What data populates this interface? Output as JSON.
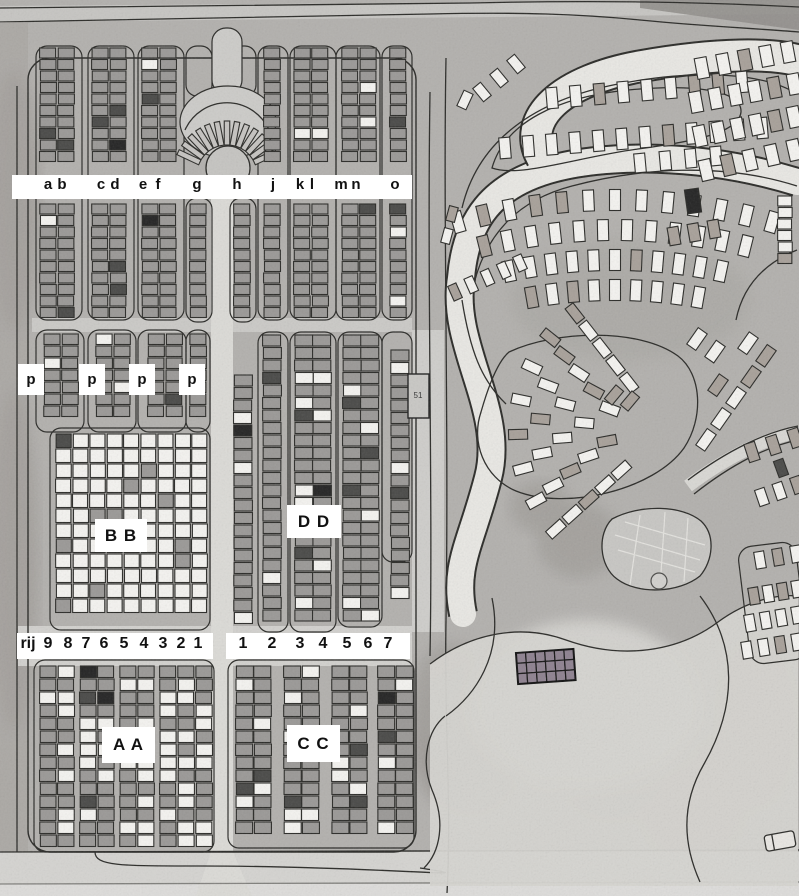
{
  "map": {
    "type": "cemetery-aerial-plan",
    "colors": {
      "background": "#b3b1ae",
      "road": "#dcdbd7",
      "bright_path": "#e9e8e4",
      "outline": "#2b2b28",
      "grave_gray": "#9b9997",
      "grave_light": "#f4f3f0",
      "grave_tan": "#a8a19a",
      "grave_dark": "#4a4a48",
      "grave_black": "#242424",
      "monument": "#8e8290",
      "label_bg": "#ffffff",
      "label_text": "#111111"
    },
    "labels": {
      "column_letters": [
        "a",
        "b",
        "c",
        "d",
        "e",
        "f",
        "g",
        "h",
        "j",
        "k",
        "l",
        "m",
        "n",
        "o"
      ],
      "column_letter_x": [
        48,
        62,
        101,
        115,
        143,
        158,
        197,
        237,
        273,
        300,
        312,
        341,
        356,
        395
      ],
      "column_band": {
        "x": 12,
        "y": 175,
        "w": 400,
        "h": 24
      },
      "p_labels": [
        "p",
        "p",
        "p",
        "p"
      ],
      "p_positions": [
        [
          18,
          364
        ],
        [
          79,
          364
        ],
        [
          129,
          364
        ],
        [
          179,
          364
        ]
      ],
      "sections": [
        {
          "text": "B B",
          "x": 95,
          "y": 519,
          "w": 52,
          "h": 33
        },
        {
          "text": "D D",
          "x": 287,
          "y": 505,
          "w": 54,
          "h": 33
        },
        {
          "text": "A A",
          "x": 102,
          "y": 727,
          "w": 53,
          "h": 36
        },
        {
          "text": "C C",
          "x": 287,
          "y": 725,
          "w": 53,
          "h": 37
        }
      ],
      "left_row_strip": {
        "box": [
          17,
          633,
          196,
          26
        ],
        "tokens": [
          "rij",
          "9",
          "8",
          "7",
          "6",
          "5",
          "4",
          "3",
          "2",
          "1"
        ],
        "token_x": [
          28,
          48,
          68,
          86,
          104,
          124,
          144,
          163,
          181,
          198
        ]
      },
      "right_row_strip": {
        "box": [
          226,
          633,
          184,
          26
        ],
        "tokens": [
          "1",
          "2",
          "3",
          "4",
          "5",
          "6",
          "7"
        ],
        "token_x": [
          243,
          272,
          300,
          323,
          347,
          368,
          388
        ]
      },
      "plot_marker": {
        "text": "51",
        "x": 418,
        "y": 391
      }
    }
  }
}
